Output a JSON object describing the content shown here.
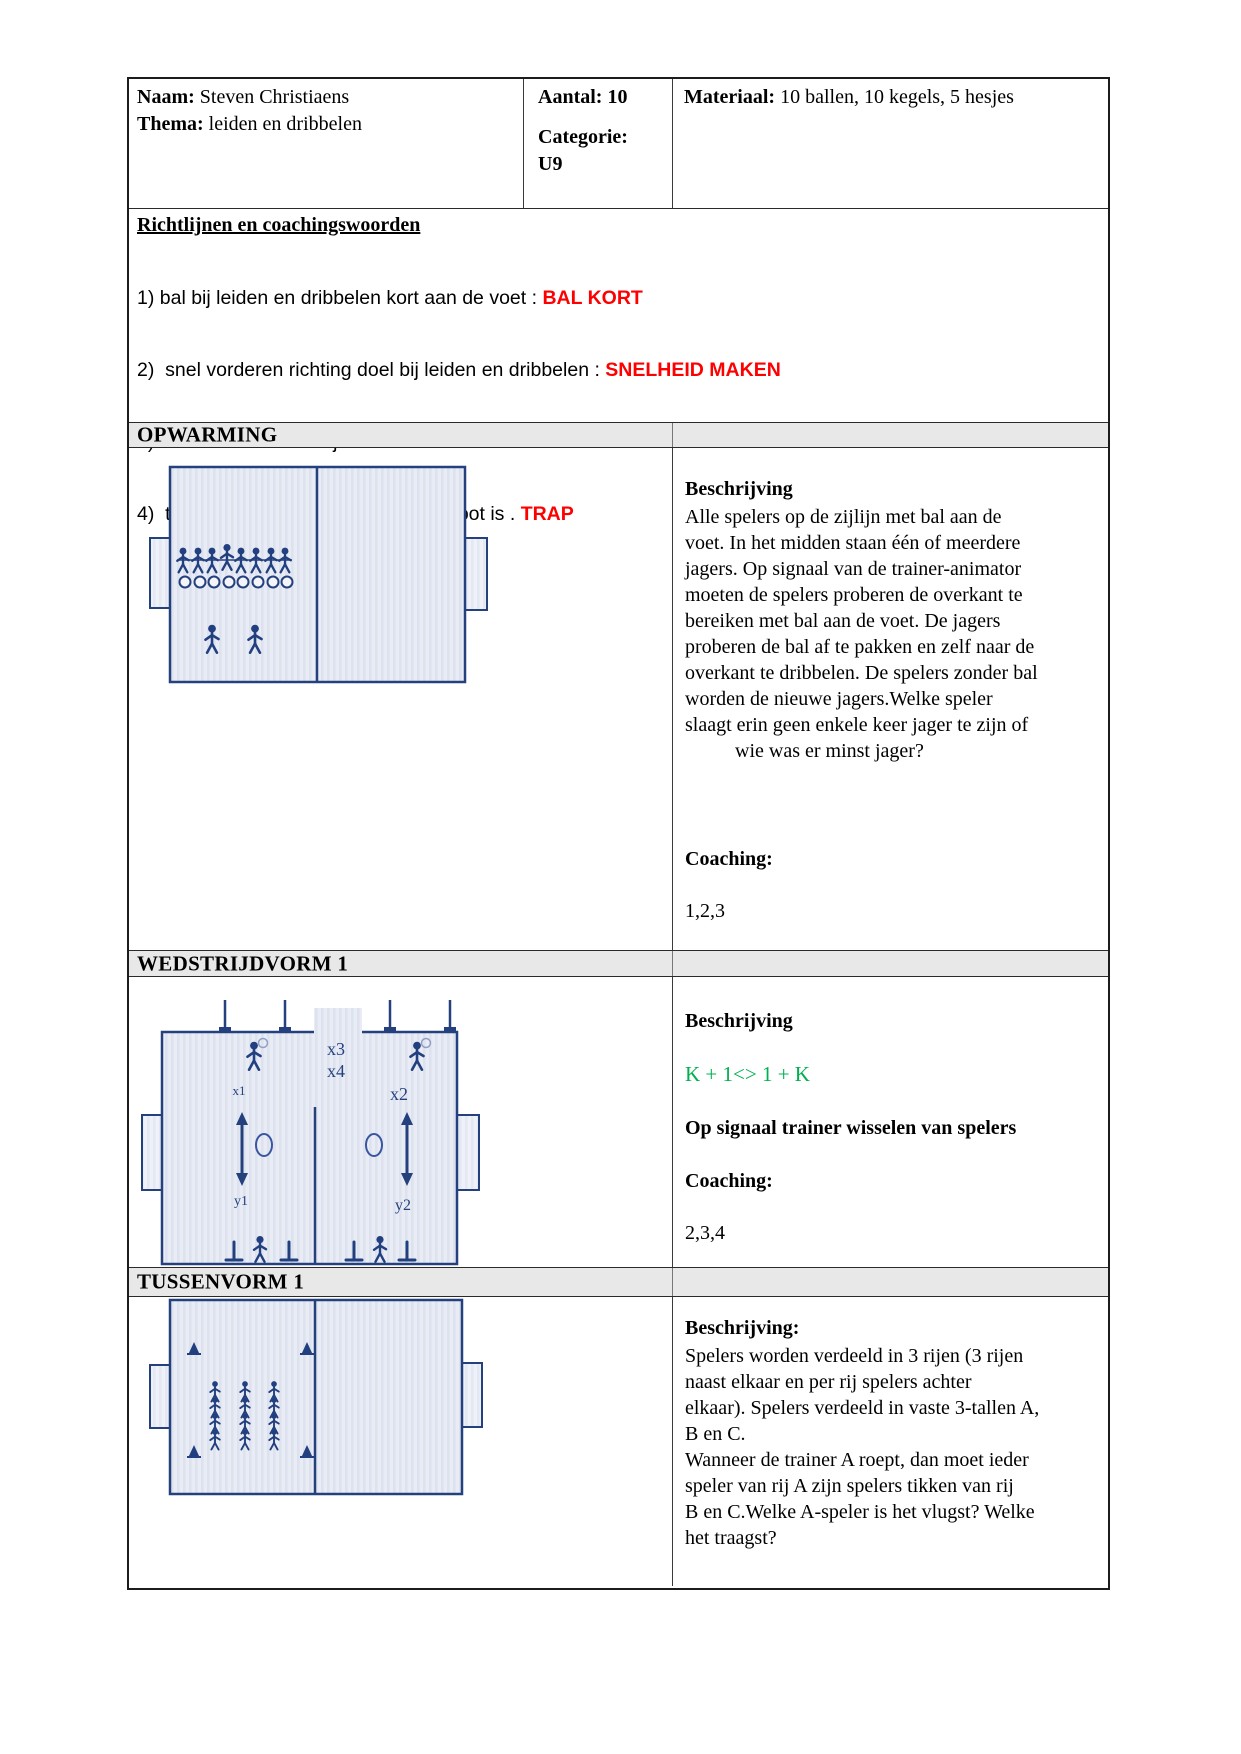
{
  "header": {
    "naam_label": "Naam:",
    "naam_value": " Steven Christiaens",
    "thema_label": "Thema:",
    "thema_value": " leiden en dribbelen",
    "aantal": "Aantal: 10",
    "categorie_label": "Categorie:",
    "categorie_value": "U9",
    "materiaal_label": "Materiaal:",
    "materiaal_value": " 10 ballen, 10 kegels, 5 hesjes"
  },
  "richtlijnen": {
    "title": "Richtlijnen en coachingswoorden",
    "items": [
      {
        "text": "1) bal bij leiden en dribbelen kort aan de voet : ",
        "keyword": "BAL KORT"
      },
      {
        "text": "2)  snel vorderen richting doel bij leiden en dribbelen : ",
        "keyword": "SNELHEID MAKEN"
      },
      {
        "text": "3)  bewaar overzicht bij leiden en dribbelen : ",
        "keyword": "KIJK"
      },
      {
        "text": "4)  trap naar doel als scoringskans groot is . ",
        "keyword": "TRAP"
      }
    ],
    "keyword_color": "#ff0000"
  },
  "sections": {
    "opwarming": {
      "title": "OPWARMING",
      "beschrijving_label": "Beschrijving",
      "beschrijving": "Alle spelers op de zijlijn met bal aan de\nvoet. In het midden staan één of meerdere\njagers. Op signaal van de trainer-animator\nmoeten de spelers proberen de overkant te\nbereiken met bal aan de voet. De jagers\nproberen de bal af te pakken en zelf naar de\noverkant te dribbelen. De spelers zonder bal\nworden de nieuwe jagers.Welke speler\nslaagt erin geen enkele keer jager te zijn of\n          wie was er minst jager?",
      "coaching_label": "Coaching:",
      "coaching": "1,2,3"
    },
    "wedstrijdvorm": {
      "title": "WEDSTRIJDVORM 1",
      "beschrijving_label": "Beschrijving",
      "formula": "K + 1<> 1 + K",
      "formula_color": "#00b050",
      "note": "Op signaal trainer wisselen van spelers",
      "coaching_label": "Coaching:",
      "coaching": "2,3,4",
      "labels": {
        "x1": "x1",
        "x2": "x2",
        "x3": "x3",
        "x4": "x4",
        "y1": "y1",
        "y2": "y2"
      }
    },
    "tussenvorm": {
      "title": "TUSSENVORM 1",
      "beschrijving_label": "Beschrijving:",
      "beschrijving": "Spelers worden verdeeld in 3 rijen (3 rijen\nnaast elkaar en per rij spelers achter\nelkaar). Spelers verdeeld in vaste 3-tallen A,\nB en C.\nWanneer de trainer A roept, dan moet ieder\nspeler van rij A zijn spelers tikken van rij\nB en C.Welke A-speler is het vlugst? Welke\nhet traagst?"
    }
  },
  "diagram_colors": {
    "field_line": "#24417e",
    "figure": "#22407f",
    "field_fill_base": "#eaecf5",
    "field_fill_stripe": "#dde2ef",
    "section_bar_fill": "#e8e8e8"
  }
}
